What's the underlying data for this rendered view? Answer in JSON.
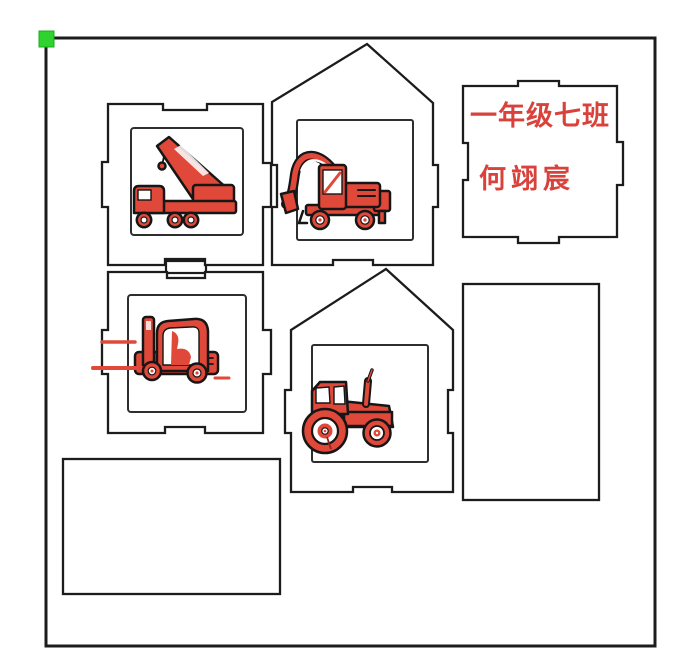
{
  "colors": {
    "cut_line": "#1c1c1c",
    "vehicle_red": "#e0483a",
    "text_red": "#d8423b",
    "origin_marker_green": "#2ed32e",
    "background": "#ffffff"
  },
  "name_plate": {
    "line1": "一年级七班",
    "line2": "何翊宸"
  },
  "icons": {
    "crane": "crane-truck-icon",
    "excavator": "excavator-icon",
    "forklift": "forklift-icon",
    "tractor": "tractor-icon",
    "origin": "origin-marker"
  }
}
